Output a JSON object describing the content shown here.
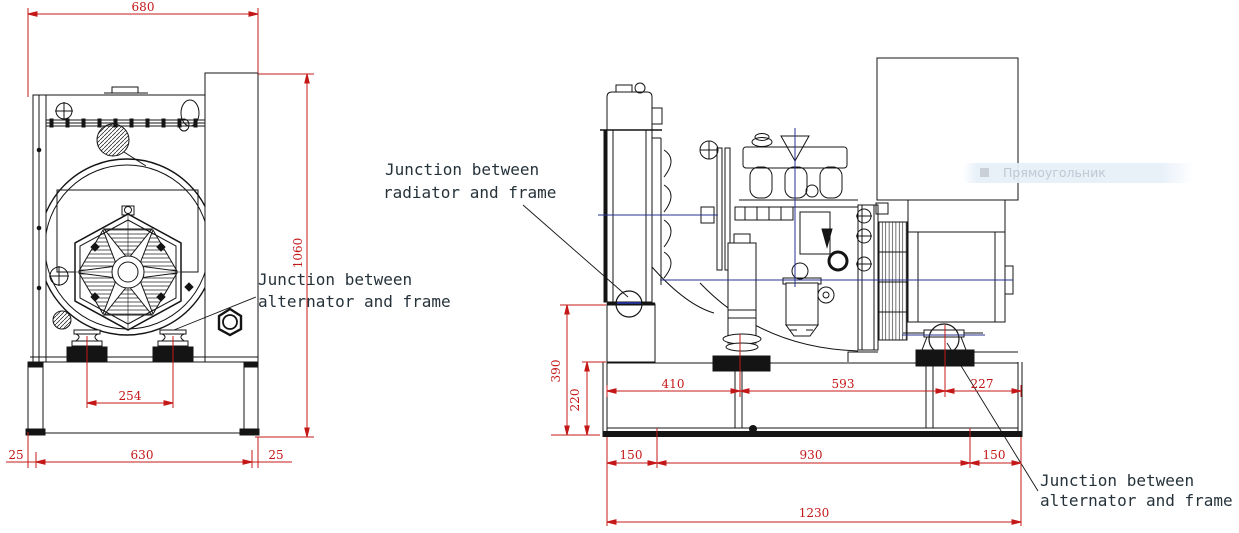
{
  "page": {
    "width": 1239,
    "height": 533,
    "background": "#ffffff"
  },
  "colors": {
    "dimension_red": "#c41818",
    "drawing_black": "#141414",
    "centerline_blue": "#24308f",
    "overlay_bg": "#e6eff8",
    "overlay_text": "#bec9d4"
  },
  "front_view": {
    "dim_top_width": "680",
    "dim_total_height": "1060",
    "dim_mount_spacing": "254",
    "dim_base_width": "630",
    "dim_base_left_margin": "25",
    "dim_base_right_margin": "25"
  },
  "side_view": {
    "dim_radiator_junction_height": "390",
    "dim_frame_height": "220",
    "dim_frame_to_engine_mount": "410",
    "dim_engine_to_alternator_mount": "593",
    "dim_alternator_mount_to_end": "227",
    "dim_left_overhang": "150",
    "dim_mount_span": "930",
    "dim_right_overhang": "150",
    "dim_total_length": "1230"
  },
  "annotations": {
    "radiator_frame_line1": "Junction between",
    "radiator_frame_line2": "radiator and frame",
    "alternator_frame_front_line1": "Junction between",
    "alternator_frame_front_line2": "alternator and frame",
    "alternator_frame_side_line1": "Junction between",
    "alternator_frame_side_line2": "alternator and frame"
  },
  "overlay": {
    "label": "Прямоугольник",
    "icon": "rectangle-icon"
  }
}
